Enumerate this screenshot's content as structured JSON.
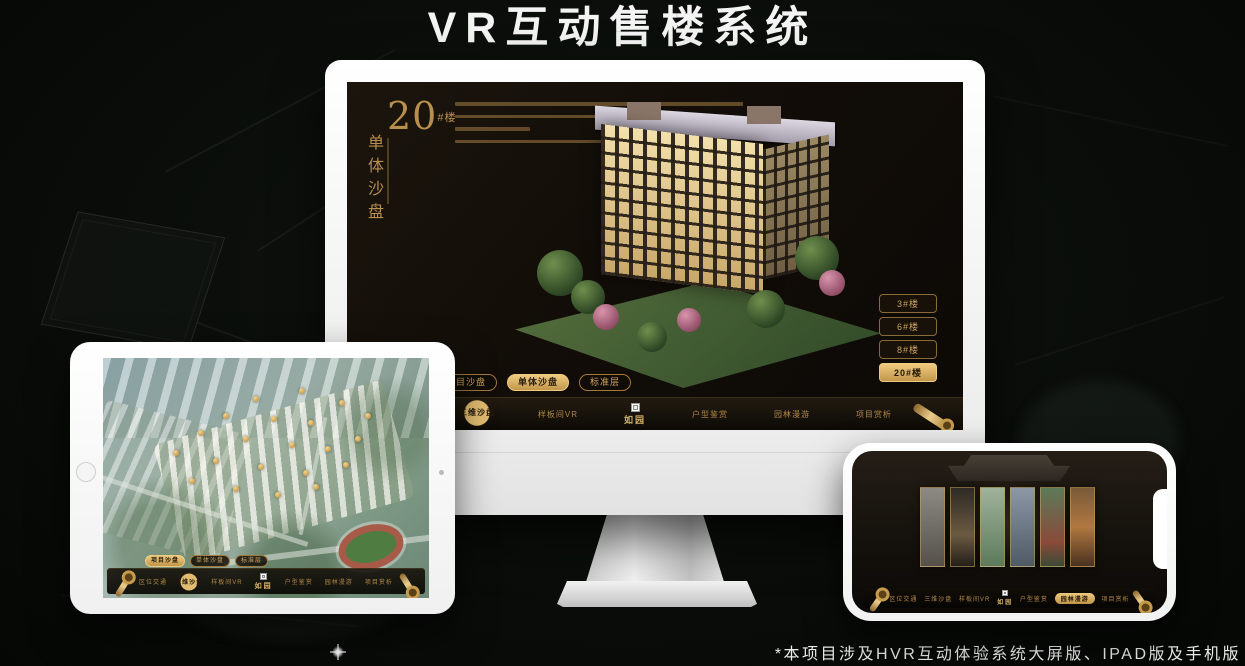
{
  "header": {
    "title": "VR互动售楼系统"
  },
  "footer": {
    "note": "*本项目涉及HVR互动体验系统大屏版、IPAD版及手机版"
  },
  "colors": {
    "gold": "#cda35c",
    "gold_active": "#eecb80",
    "screen_bg": "#14100a",
    "page_bg": "#0a0d0a",
    "title_text": "#f4f4f4"
  },
  "nav": {
    "logo": "如园",
    "items": [
      "区位交通",
      "三维沙盘",
      "样板间VR",
      "户型鉴赏",
      "园林漫游",
      "项目赏析"
    ]
  },
  "tabs": [
    "项目沙盘",
    "单体沙盘",
    "标准层"
  ],
  "monitor": {
    "building_no": "20",
    "building_no_suffix": "#楼",
    "building_subtitle": "单体沙盘",
    "floor_buttons": [
      "3#楼",
      "6#楼",
      "8#楼",
      "20#楼"
    ],
    "active_floor": "20#楼",
    "active_tab": "单体沙盘",
    "active_nav": "三维沙盘"
  },
  "tablet": {
    "active_tab": "项目沙盘",
    "active_nav": "三维沙盘"
  },
  "phone": {
    "active_nav": "园林漫游"
  }
}
